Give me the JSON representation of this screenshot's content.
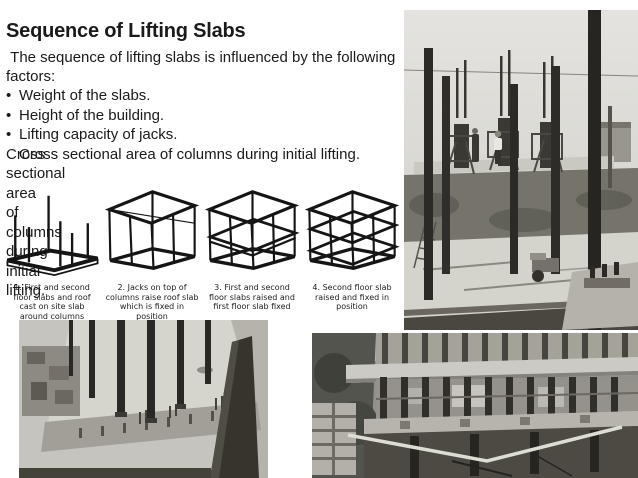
{
  "colors": {
    "background": "#ffffff",
    "text": "#1a1a1a"
  },
  "slide": {
    "title": "Sequence of Lifting Slabs",
    "intro": " The sequence of lifting slabs is influenced by the following factors:",
    "bullet_char": "•",
    "bullets": [
      "Weight of the slabs.",
      "Height of the building.",
      "Lifting capacity of jacks.",
      "Cross sectional area of columns during initial lifting."
    ]
  },
  "diagram": {
    "captions": [
      "1. First and second floor slabs and roof cast on site slab around columns",
      "2. Jacks on top of columns raise roof slab which is fixed in position",
      "3. First and second floor slabs raised and first floor slab fixed",
      "4. Second floor slab raised and fixed in position"
    ]
  }
}
